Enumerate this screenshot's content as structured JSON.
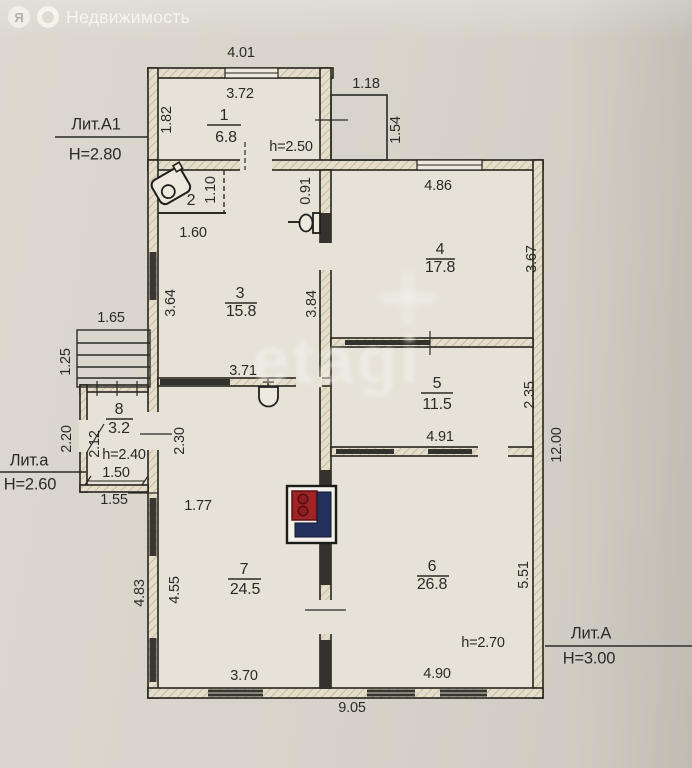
{
  "watermark": {
    "brand_letter": "Я",
    "brand_name": "Недвижимость",
    "center_text": "etagi"
  },
  "buildings": {
    "litA1": {
      "label": "Лит.А1",
      "height": "Н=2.80"
    },
    "lita": {
      "label": "Лит.а",
      "height": "Н=2.60"
    },
    "litA": {
      "label": "Лит.А",
      "height": "Н=3.00"
    }
  },
  "rooms": {
    "r1": {
      "num": "1",
      "area": "6.8",
      "note": "h=2.50"
    },
    "r2": {
      "num": "2"
    },
    "r3": {
      "num": "3",
      "area": "15.8"
    },
    "r4": {
      "num": "4",
      "area": "17.8"
    },
    "r5": {
      "num": "5",
      "area": "11.5"
    },
    "r6": {
      "num": "6",
      "area": "26.8",
      "note": "h=2.70"
    },
    "r7": {
      "num": "7",
      "area": "24.5"
    },
    "r8": {
      "num": "8",
      "area": "3.2",
      "note": "h=2.40"
    }
  },
  "dims": {
    "annexe_top_outer": "4.01",
    "room1_top": "3.72",
    "room1_left": "1.82",
    "porch_top": "1.18",
    "porch_right": "1.54",
    "room2_right": "1.10",
    "room2_bottom": "1.60",
    "wc_right": "0.91",
    "room4_top": "4.86",
    "room4_right": "3.67",
    "room3_left": "3.64",
    "room3_right": "3.84",
    "room3_bottom": "3.71",
    "steps_top": "1.65",
    "steps_left": "1.25",
    "room5_right": "2.35",
    "room5_bottom": "4.91",
    "right_total": "12.00",
    "room8_outer_left": "2.20",
    "room8_left": "2.12",
    "room8_bottom": "1.50",
    "room8_bottom_outer": "1.55",
    "room7_upper_left": "2.30",
    "room7_top": "1.77",
    "room7_outer_left": "4.83",
    "room7_left": "4.55",
    "room6_right": "5.51",
    "room7_bottom": "3.70",
    "room6_bottom": "4.90",
    "bottom_total": "9.05"
  }
}
